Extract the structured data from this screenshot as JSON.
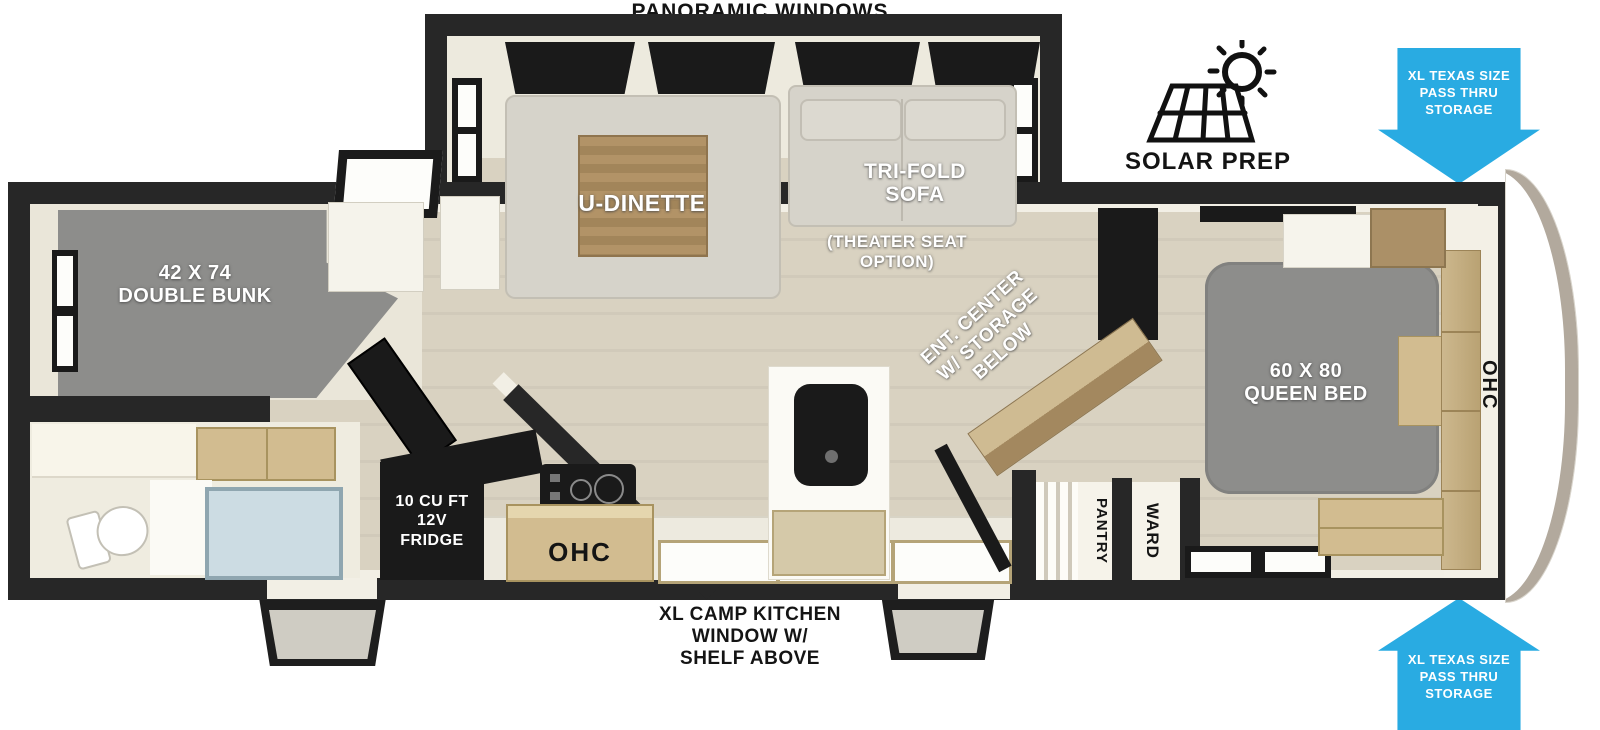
{
  "labels": {
    "panoramic_windows": "PANORAMIC WINDOWS",
    "solar_prep": "SOLAR PREP",
    "pass_thru_storage": "XL TEXAS SIZE\nPASS THRU\nSTORAGE",
    "u_dinette": "U-DINETTE",
    "tri_fold_sofa": "TRI-FOLD\nSOFA",
    "theater_seat_option": "(THEATER SEAT\nOPTION)",
    "ent_center": "ENT. CENTER\nW/ STORAGE\nBELOW",
    "queen_bed": "60 X 80\nQUEEN BED",
    "ohc_bedroom": "OHC",
    "double_bunk": "42 X 74\nDOUBLE BUNK",
    "fridge": "10 CU FT\n12V\nFRIDGE",
    "ohc_kitchen": "OHC",
    "pantry": "PANTRY",
    "ward": "WARD",
    "camp_kitchen_window": "XL CAMP KITCHEN\nWINDOW W/\nSHELF ABOVE"
  },
  "icons": {
    "solar_prep": "solar-panel-sun-icon",
    "storage_arrows": "blue-directional-arrow"
  },
  "colors": {
    "arrow_blue": "#29ABE2",
    "wall": "#272727",
    "floor": "#D9D2C1",
    "floor_stripe": "#D1CABA",
    "furniture_gray": "#8D8D8B",
    "sofa": "#D6D3CA",
    "cabinet_tan": "#D2BC90",
    "table_wood": "#AB8E60",
    "shower_glass": "#CCDCE3",
    "appliance_black": "#1A1A1A",
    "trim_white": "#F2EFE5"
  }
}
